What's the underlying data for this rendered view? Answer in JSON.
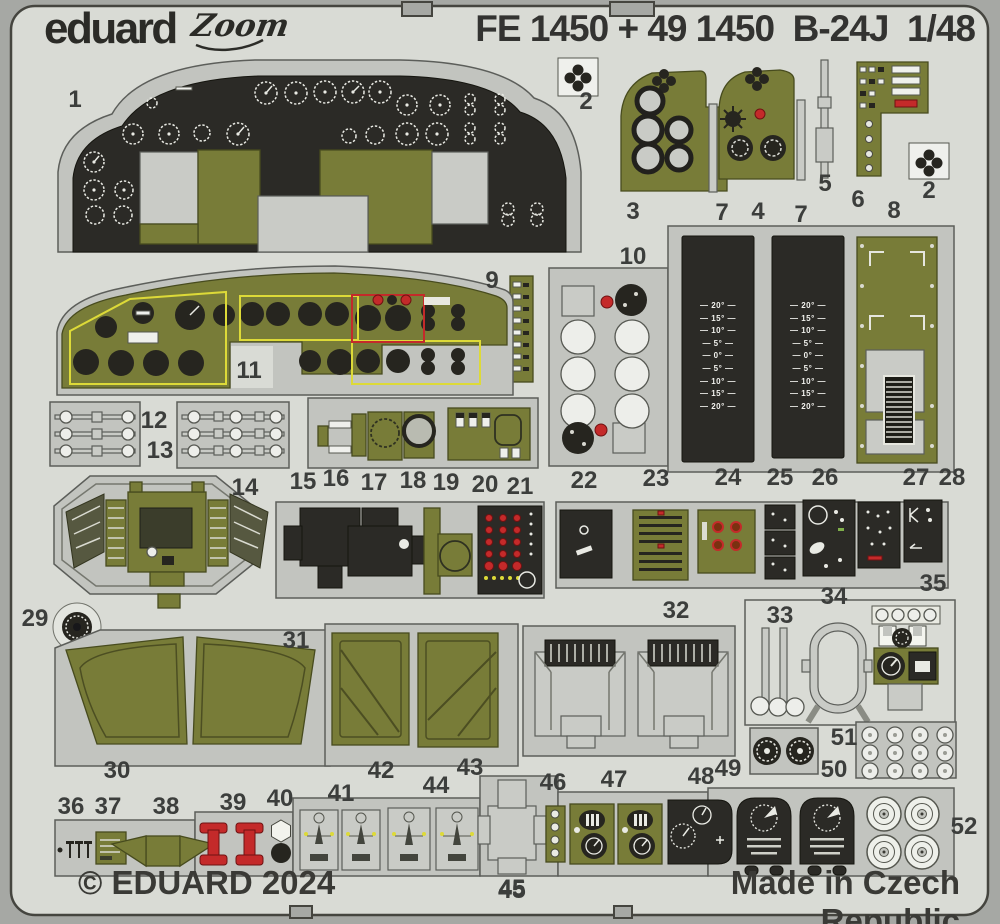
{
  "header": {
    "brand": "eduard",
    "series_logo": "Zoom",
    "title": "FE 1450 + 49 1450  B-24J  1/48"
  },
  "footer": {
    "copyright": "© EDUARD 2024",
    "center_part_number": "45",
    "made_in": "Made in Czech Republic"
  },
  "colors": {
    "bg": "#a6a8a4",
    "sheet": "#d9dbd5",
    "plate": "#c2c4bf",
    "olive": "#787c38",
    "blackpart": "#2b2a26",
    "red": "#c42a2a",
    "yellow": "#ddda38"
  },
  "flap_panels": {
    "x_positions": [
      682,
      772
    ],
    "scale_labels": [
      "20°",
      "15°",
      "10°",
      "5°",
      "0°",
      "5°",
      "10°",
      "15°",
      "20°"
    ]
  },
  "part_labels": [
    {
      "n": "1",
      "x": 75,
      "y": 100
    },
    {
      "n": "2",
      "x": 586,
      "y": 102
    },
    {
      "n": "3",
      "x": 633,
      "y": 212
    },
    {
      "n": "7",
      "x": 722,
      "y": 213
    },
    {
      "n": "4",
      "x": 758,
      "y": 212
    },
    {
      "n": "7",
      "x": 801,
      "y": 215
    },
    {
      "n": "5",
      "x": 825,
      "y": 184
    },
    {
      "n": "6",
      "x": 858,
      "y": 200
    },
    {
      "n": "8",
      "x": 894,
      "y": 211
    },
    {
      "n": "2",
      "x": 929,
      "y": 191
    },
    {
      "n": "9",
      "x": 492,
      "y": 281
    },
    {
      "n": "10",
      "x": 633,
      "y": 257
    },
    {
      "n": "11",
      "x": 249,
      "y": 371
    },
    {
      "n": "12",
      "x": 154,
      "y": 421
    },
    {
      "n": "13",
      "x": 160,
      "y": 451
    },
    {
      "n": "14",
      "x": 245,
      "y": 488
    },
    {
      "n": "15",
      "x": 303,
      "y": 482
    },
    {
      "n": "16",
      "x": 336,
      "y": 479
    },
    {
      "n": "17",
      "x": 374,
      "y": 483
    },
    {
      "n": "18",
      "x": 413,
      "y": 481
    },
    {
      "n": "19",
      "x": 446,
      "y": 483
    },
    {
      "n": "20",
      "x": 485,
      "y": 485
    },
    {
      "n": "21",
      "x": 520,
      "y": 487
    },
    {
      "n": "22",
      "x": 584,
      "y": 481
    },
    {
      "n": "23",
      "x": 656,
      "y": 479
    },
    {
      "n": "24",
      "x": 728,
      "y": 478
    },
    {
      "n": "25",
      "x": 780,
      "y": 478
    },
    {
      "n": "26",
      "x": 825,
      "y": 478
    },
    {
      "n": "27",
      "x": 916,
      "y": 478
    },
    {
      "n": "28",
      "x": 952,
      "y": 478
    },
    {
      "n": "29",
      "x": 35,
      "y": 619
    },
    {
      "n": "30",
      "x": 117,
      "y": 771
    },
    {
      "n": "31",
      "x": 296,
      "y": 641
    },
    {
      "n": "32",
      "x": 676,
      "y": 611
    },
    {
      "n": "33",
      "x": 780,
      "y": 616
    },
    {
      "n": "34",
      "x": 834,
      "y": 597
    },
    {
      "n": "35",
      "x": 933,
      "y": 584
    },
    {
      "n": "36",
      "x": 71,
      "y": 807
    },
    {
      "n": "37",
      "x": 108,
      "y": 807
    },
    {
      "n": "38",
      "x": 166,
      "y": 807
    },
    {
      "n": "39",
      "x": 233,
      "y": 803
    },
    {
      "n": "40",
      "x": 280,
      "y": 799
    },
    {
      "n": "41",
      "x": 341,
      "y": 794
    },
    {
      "n": "42",
      "x": 381,
      "y": 771
    },
    {
      "n": "43",
      "x": 470,
      "y": 768
    },
    {
      "n": "44",
      "x": 436,
      "y": 786
    },
    {
      "n": "45",
      "x": 512,
      "y": 889
    },
    {
      "n": "46",
      "x": 553,
      "y": 783
    },
    {
      "n": "47",
      "x": 614,
      "y": 780
    },
    {
      "n": "48",
      "x": 701,
      "y": 777
    },
    {
      "n": "49",
      "x": 728,
      "y": 769
    },
    {
      "n": "50",
      "x": 834,
      "y": 770
    },
    {
      "n": "51",
      "x": 844,
      "y": 738
    },
    {
      "n": "52",
      "x": 964,
      "y": 827
    }
  ]
}
